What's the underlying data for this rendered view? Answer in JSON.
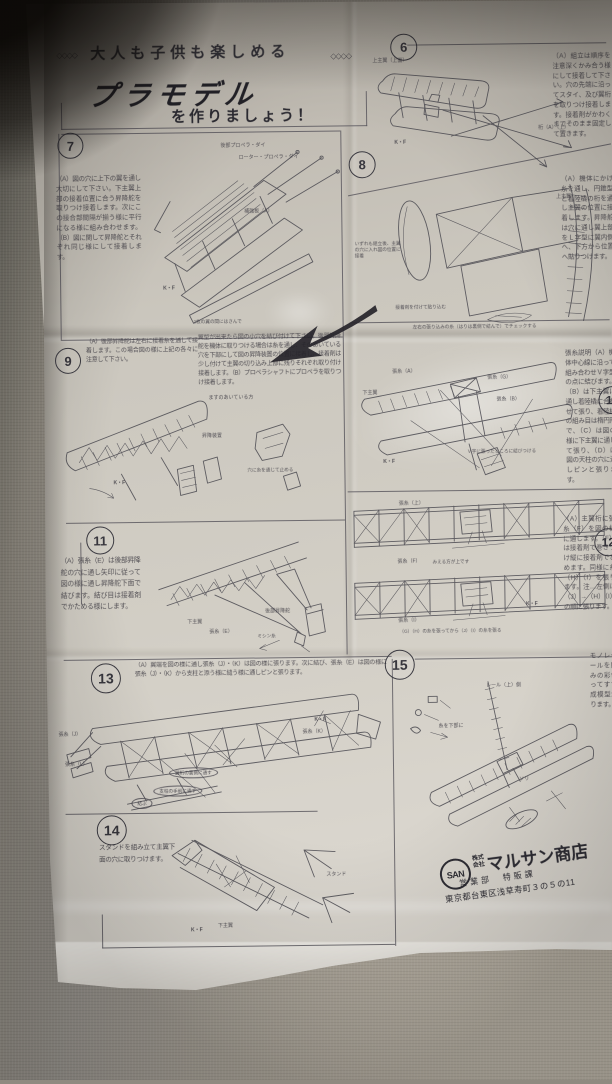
{
  "header": {
    "deco_left": "◇◇◇◇",
    "tagline": "大人も子供も楽しめる",
    "deco_right": "◇◇◇◇",
    "brand": "プラモデル",
    "subtitle": "を作りましょう！"
  },
  "sections": {
    "s6": {
      "num": "6",
      "text": "（A）組立は順序を注意深くかみ合う様にして接着して下さい。穴の先端に沿ってスタイ、及び翼桁を取りつけ接着します。接着剤がかわくまでそのまま固定して置きます。",
      "labels": {
        "wing": "上主翼（上面）",
        "spar": "桁（A）（上）",
        "mark": "K・F"
      }
    },
    "s7": {
      "num": "7",
      "text": "（A）図の穴に上下の翼を通し大切にして下さい。下主翼上部の接着位置に合う昇降舵を取りつけ接着します。次にこの接合部間隔が揃う様に平行になる様に組み合わせます。（B）図に関して昇降舵とそれぞれ同じ様にして接着します。",
      "labels": {
        "top": "後部プロペラ・ダイ",
        "top2": "ローター・プロペラ・ダイ",
        "mid": "補強板（A）",
        "mark": "K・F",
        "caption": "2枚の翼の間にはさんで"
      }
    },
    "s8": {
      "num": "8",
      "text": "（A）機体にかけ糸を通し、円錐型と着陸橇の桁を通し主翼の位置に接着します。昇降舵は穴に通し翼上部をＬ字型に翼内側へ、下方から位置へ貼りつけます。",
      "labels": {
        "block": "いずれも組立後、主翼の穴に入れ図の位置に接着",
        "wing": "上主翼",
        "glue": "接着剤を付けて貼り込む",
        "caption": "左右の張り込みの糸（はりは裏側で結んで）でチェックする"
      }
    },
    "s9": {
      "num": "9",
      "text1": "（A）後部昇降舵は左右に接着糸を通して接着します。この場合図の様に上記の各々に注意して下さい。",
      "text2": "翼型が出来たら図の小穴を結び付けて下さい。後部昇降舵を機体に取りつける場合は糸を通し、そのあいている穴を下部にして図の昇降装置の位置に接着し、接着剤は少し付けて主翼の切り込み上部に残りそれぞれ取り付け接着します。（B）プロペラシャフトにプロペラを取りつけ接着します。",
      "labels": {
        "l1": "ますのあいている方",
        "l2": "昇降装置",
        "l3": "穴に糸を通じて止める",
        "mark": "K・F"
      }
    },
    "s10": {
      "num": "10",
      "text": "張糸説明（A）機体中心線に沿って組み合わせＶ字型の点に結びます。（B）は下主翼に通し着陸橇に合わせて張り、着陸橇の組み目は楕円形で、（C）は図の様に下主翼に通して張り、（D）は図の天柱の穴に通しピンと張ります。",
      "labels": {
        "l1": "張糸（A）",
        "l2": "張糸（G）",
        "l3": "下主翼",
        "l4": "張糸（B）",
        "caption": "Ｖ字に張ったところに結びつける",
        "mark": "K・F"
      }
    },
    "s11": {
      "num": "11",
      "text": "（A）張糸（E）は後部昇降舵の穴に通し矢印に従って図の様に通し昇降舵下面で結びます。結び目は接着剤でかためる様にします。",
      "labels": {
        "l1": "下主翼",
        "l2": "張糸（E）",
        "l3": "後部昇降舵",
        "l4": "ミシン糸"
      }
    },
    "s12": {
      "num": "12",
      "text": "（A）主翼桁に張糸（F）を図の様に通します。（F）は接着剤で巻きつけ縦に接着剤でとめます。同様に糸（H）（I）を張ります。注…左側は（J）→（H）（I）の順に張ります。",
      "labels": {
        "top": "張糸（上）",
        "l1": "張糸（F）",
        "note": "みえる方が上です",
        "l2": "張糸（I）",
        "caption": "（G）（H）の糸を張ってから（J）（I）の糸を張る",
        "mark": "K・F"
      }
    },
    "s13": {
      "num": "13",
      "header": "（A）翼端を図の様に通し張糸（J）・（K）は図の様に張ります。次に結び、張糸（E）は図の様に張糸（J）・（K）から支柱と添う様に縫う様に通しピンと張ります。",
      "labels": {
        "l1": "張糸（J）",
        "l2": "張糸（K）",
        "l3": "張糸（L）",
        "mark": "K・F",
        "b1": "翼桁の裏側に通す",
        "b2": "支柱の手前に通す",
        "b3": "結ぶ"
      }
    },
    "s14": {
      "num": "14",
      "text": "スタンドを組み立て主翼下面の穴に取りつけます。",
      "labels": {
        "l1": "スタンド",
        "l2": "下主翼",
        "mark": "K・F"
      }
    },
    "s15": {
      "num": "15",
      "text": "モノレールにデカールを貼り、入組みの彩色を図に従ってすすめれば完成模型が出来上がります。",
      "labels": {
        "l1": "レール（上）側",
        "l2": "糸を下部に",
        "l3": "ソリ"
      }
    }
  },
  "publisher": {
    "logo": "SAN",
    "company_prefix_1": "株式",
    "company_prefix_2": "会社",
    "name": "マルサン商店",
    "department": "営業部　特販課",
    "address": "東京都台東区浅草寿町３の５の11"
  }
}
